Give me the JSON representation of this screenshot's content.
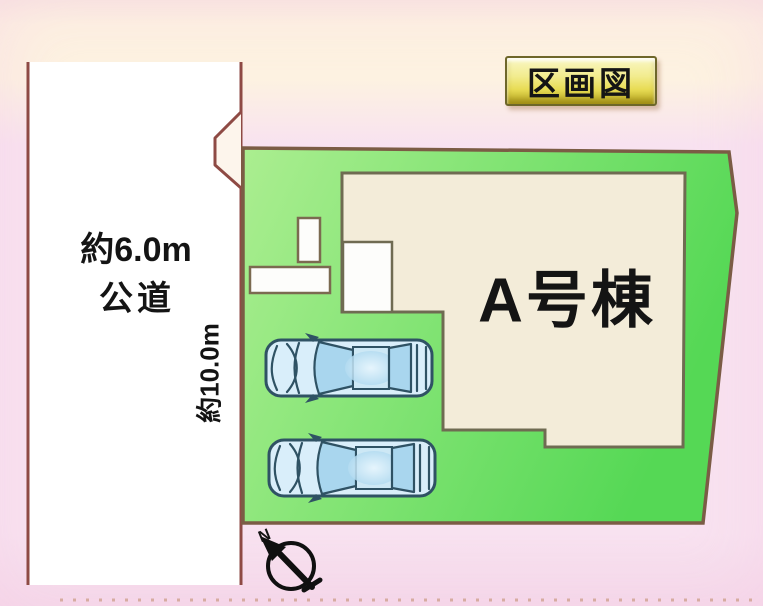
{
  "title": "区画図",
  "road": {
    "width_label": "約6.0m",
    "type_label": "公道"
  },
  "plot": {
    "depth_label": "約10.0m"
  },
  "building": {
    "label": "A号棟"
  },
  "compass": {
    "north_label": "N"
  },
  "colors": {
    "bg_peach": "#fdf2e1",
    "bg_pink": "#f8e2f0",
    "road_fill": "#ffffff",
    "road_line": "#8e4a44",
    "plot_border": "#7b5c45",
    "plot_fill_light": "#abee90",
    "plot_fill_dark": "#55d855",
    "building_fill": "#f3ecd9",
    "building_border": "#6f6b52",
    "car_outline": "#2f5264",
    "car_body": "#d9eefa",
    "car_glass": "#a9d6ee",
    "title_gold_top": "#faf7c6",
    "title_gold_dark": "#b5a41e",
    "text_color": "#141414"
  }
}
